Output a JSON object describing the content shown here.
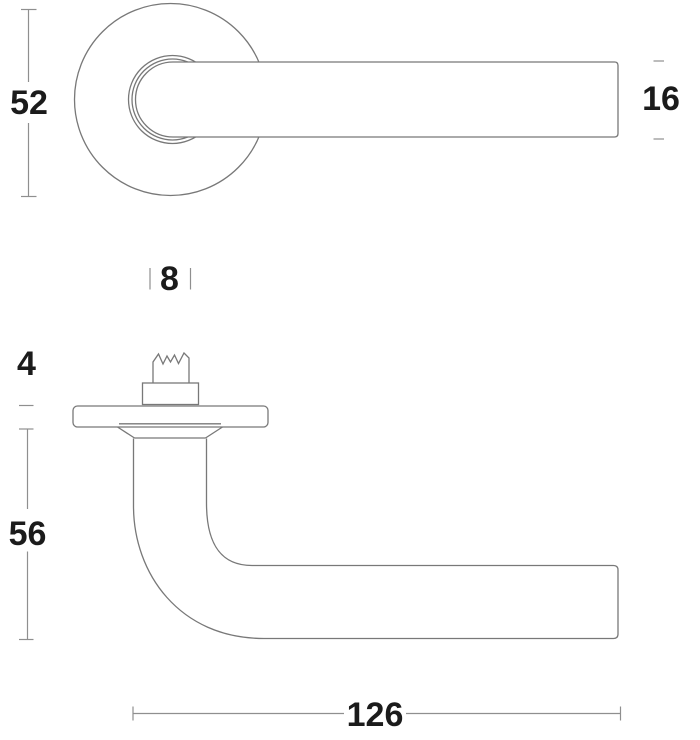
{
  "colors": {
    "background": "#ffffff",
    "drawing_line": "#787878",
    "dimension_line": "#8f8f8f",
    "label_text": "#1b1b1b"
  },
  "dimensions": {
    "front": {
      "rose_diameter": "52",
      "lever_profile_height": "16",
      "spindle_width": "8"
    },
    "side": {
      "rose_thickness": "4",
      "projection": "56",
      "lever_length": "126"
    }
  }
}
